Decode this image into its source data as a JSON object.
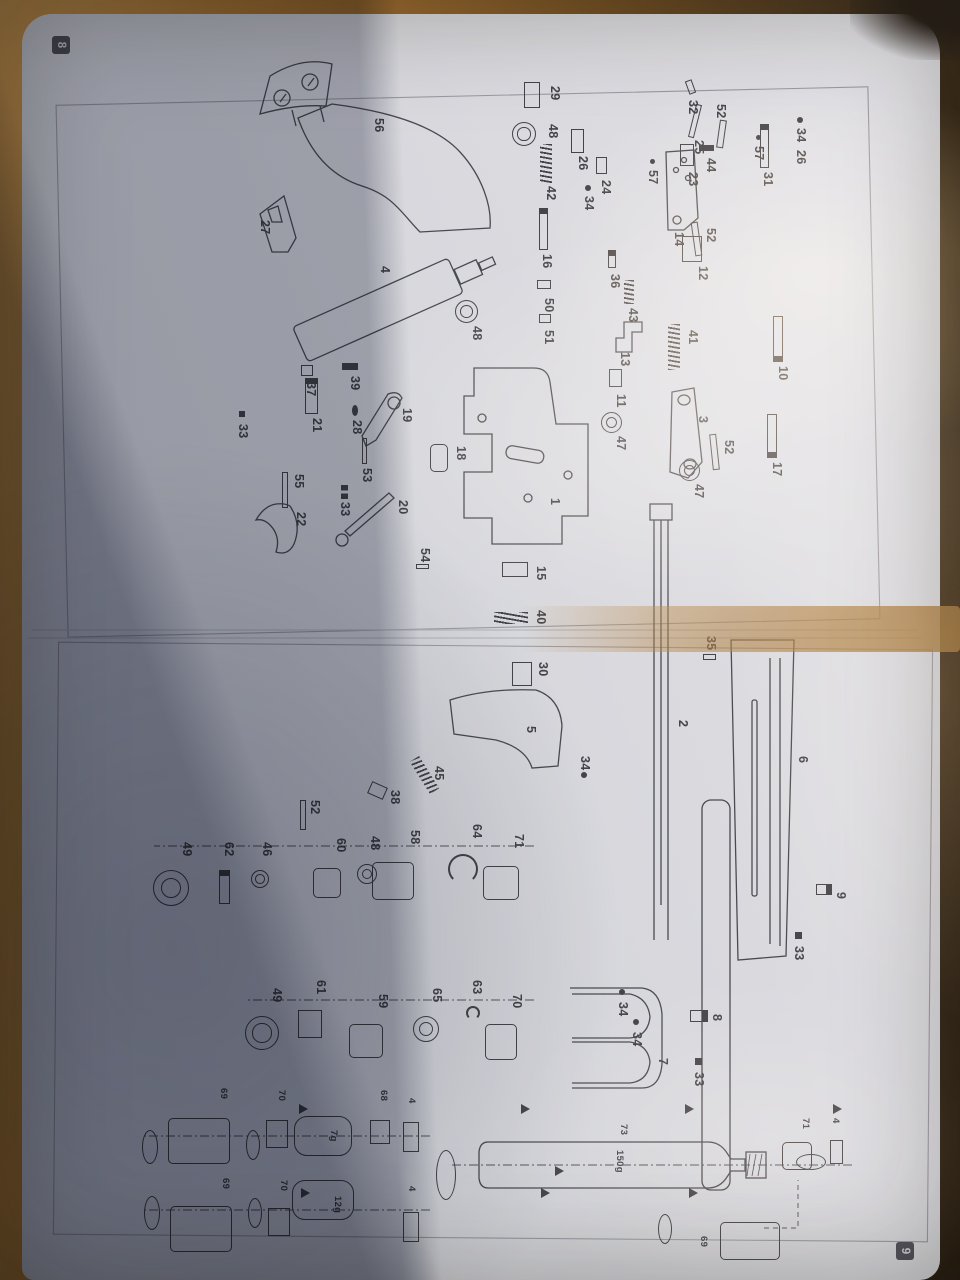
{
  "document": {
    "type": "exploded-parts-diagram",
    "badges": {
      "page_left": "8",
      "page_right": "9"
    }
  },
  "colors": {
    "ink": "#43434a",
    "paper": "#d8d8dc",
    "table": "#b97c35"
  },
  "diagram": {
    "capsules": {
      "small": "7g",
      "medium": "12g",
      "bottle": "150g",
      "bottle_part": "73"
    },
    "parts": [
      {
        "l": "56",
        "x": 118,
        "y": 572
      },
      {
        "l": "32",
        "x": 100,
        "y": 258,
        "k": "pin",
        "sx": -20,
        "sy": 8,
        "sw": 14,
        "sh": 7,
        "r": -20
      },
      {
        "l": "25",
        "x": 140,
        "y": 252,
        "k": "pin",
        "sx": -36,
        "sy": 10,
        "sw": 34,
        "sh": 6,
        "r": 14
      },
      {
        "l": "23",
        "x": 172,
        "y": 258,
        "k": "rect",
        "sx": -28,
        "sy": 8,
        "sw": 22,
        "sh": 14
      },
      {
        "l": "52",
        "x": 104,
        "y": 230,
        "k": "pin",
        "sx": 16,
        "sy": 5,
        "sw": 28,
        "sh": 7,
        "r": 8
      },
      {
        "l": "29",
        "x": 86,
        "y": 396,
        "k": "rect",
        "sx": -4,
        "sy": 24,
        "sw": 26,
        "sh": 16
      },
      {
        "l": "48",
        "x": 124,
        "y": 398,
        "k": "ring2",
        "sx": -2,
        "sy": 26,
        "sw": 24,
        "sh": 24
      },
      {
        "l": "34",
        "x": 128,
        "y": 150,
        "k": "dot",
        "sx": -11,
        "sy": 7,
        "sw": 6,
        "sh": 6
      },
      {
        "l": "26",
        "x": 150,
        "y": 150
      },
      {
        "l": "57",
        "x": 146,
        "y": 192,
        "k": "dot",
        "sx": -11,
        "sy": 7,
        "sw": 5,
        "sh": 5
      },
      {
        "l": "44",
        "x": 158,
        "y": 240,
        "k": "bar",
        "sx": -13,
        "sy": 6,
        "sw": 6,
        "sh": 15
      },
      {
        "l": "31",
        "x": 172,
        "y": 183,
        "k": "screwh",
        "sx": -48,
        "sy": 8,
        "sw": 44,
        "sh": 9
      },
      {
        "l": "52",
        "x": 228,
        "y": 240,
        "k": "pin",
        "sx": -6,
        "sy": 20,
        "sw": 34,
        "sh": 7,
        "r": -8
      },
      {
        "l": "14",
        "x": 232,
        "y": 272
      },
      {
        "l": "26",
        "x": 156,
        "y": 368,
        "k": "rect",
        "sx": -27,
        "sy": 8,
        "sw": 24,
        "sh": 13
      },
      {
        "l": "24",
        "x": 180,
        "y": 345,
        "k": "rect",
        "sx": -23,
        "sy": 8,
        "sw": 17,
        "sh": 11
      },
      {
        "l": "34",
        "x": 196,
        "y": 362,
        "k": "dot",
        "sx": -11,
        "sy": 7,
        "sw": 6,
        "sh": 6
      },
      {
        "l": "57",
        "x": 170,
        "y": 298,
        "k": "dot",
        "sx": -11,
        "sy": 7,
        "sw": 5,
        "sh": 5
      },
      {
        "l": "42",
        "x": 186,
        "y": 400,
        "k": "spring",
        "sx": -42,
        "sy": 8,
        "sw": 40,
        "sh": 12
      },
      {
        "l": "27",
        "x": 220,
        "y": 686
      },
      {
        "l": "16",
        "x": 254,
        "y": 404,
        "k": "screwh",
        "sx": -46,
        "sy": 8,
        "sw": 42,
        "sh": 9
      },
      {
        "l": "4",
        "x": 266,
        "y": 566
      },
      {
        "l": "12",
        "x": 266,
        "y": 248,
        "k": "rect",
        "sx": -30,
        "sy": 10,
        "sw": 26,
        "sh": 20
      },
      {
        "l": "36",
        "x": 274,
        "y": 336,
        "k": "screwh",
        "sx": -24,
        "sy": 8,
        "sw": 18,
        "sh": 8
      },
      {
        "l": "50",
        "x": 298,
        "y": 402,
        "k": "rect",
        "sx": -18,
        "sy": 7,
        "sw": 9,
        "sh": 14
      },
      {
        "l": "43",
        "x": 308,
        "y": 318,
        "k": "spring",
        "sx": -28,
        "sy": 8,
        "sw": 24,
        "sh": 10
      },
      {
        "l": "51",
        "x": 330,
        "y": 402,
        "k": "rect",
        "sx": -16,
        "sy": 7,
        "sw": 9,
        "sh": 12
      },
      {
        "l": "41",
        "x": 330,
        "y": 258,
        "k": "spring",
        "sx": -6,
        "sy": 22,
        "sw": 46,
        "sh": 12
      },
      {
        "l": "13",
        "x": 352,
        "y": 326
      },
      {
        "l": "48",
        "x": 326,
        "y": 474,
        "k": "ring2",
        "sx": -26,
        "sy": 8,
        "sw": 23,
        "sh": 23
      },
      {
        "l": "10",
        "x": 366,
        "y": 168,
        "k": "screwh",
        "sx": -50,
        "sy": 9,
        "sw": 46,
        "sh": 10,
        "r": 180
      },
      {
        "l": "11",
        "x": 394,
        "y": 330,
        "k": "rect",
        "sx": -25,
        "sy": 8,
        "sw": 18,
        "sh": 13
      },
      {
        "l": "3",
        "x": 416,
        "y": 248
      },
      {
        "l": "47",
        "x": 436,
        "y": 330,
        "k": "ring2",
        "sx": -24,
        "sy": 8,
        "sw": 21,
        "sh": 21
      },
      {
        "l": "52",
        "x": 440,
        "y": 222,
        "k": "pin",
        "sx": -6,
        "sy": 20,
        "sw": 36,
        "sh": 7,
        "r": -6
      },
      {
        "l": "17",
        "x": 462,
        "y": 174,
        "k": "screwh",
        "sx": -48,
        "sy": 9,
        "sw": 44,
        "sh": 10,
        "r": 180
      },
      {
        "l": "47",
        "x": 484,
        "y": 252,
        "k": "ring2",
        "sx": -24,
        "sy": 8,
        "sw": 21,
        "sh": 21
      },
      {
        "l": "39",
        "x": 376,
        "y": 596,
        "k": "bar",
        "sx": -13,
        "sy": 6,
        "sw": 7,
        "sh": 16
      },
      {
        "l": "37",
        "x": 382,
        "y": 640,
        "k": "rect",
        "sx": -17,
        "sy": 7,
        "sw": 11,
        "sh": 12
      },
      {
        "l": "19",
        "x": 408,
        "y": 544
      },
      {
        "l": "21",
        "x": 418,
        "y": 634,
        "k": "screwh",
        "sx": -40,
        "sy": 8,
        "sw": 36,
        "sh": 13
      },
      {
        "l": "28",
        "x": 420,
        "y": 594,
        "k": "dot",
        "sx": -15,
        "sy": 8,
        "sw": 11,
        "sh": 6
      },
      {
        "l": "33",
        "x": 424,
        "y": 708,
        "k": "bar",
        "sx": -13,
        "sy": 7,
        "sw": 6,
        "sh": 6
      },
      {
        "l": "53",
        "x": 468,
        "y": 584,
        "k": "pin",
        "sx": -30,
        "sy": 9,
        "sw": 26,
        "sh": 5
      },
      {
        "l": "18",
        "x": 446,
        "y": 490,
        "k": "rrect",
        "sx": -2,
        "sy": 22,
        "sw": 28,
        "sh": 18
      },
      {
        "l": "55",
        "x": 474,
        "y": 652,
        "k": "pin",
        "sx": -2,
        "sy": 20,
        "sw": 36,
        "sh": 6
      },
      {
        "l": "22",
        "x": 512,
        "y": 650
      },
      {
        "l": "33",
        "x": 502,
        "y": 606,
        "k": "bar2",
        "sx": -17,
        "sy": 6,
        "sw": 14,
        "sh": 7
      },
      {
        "l": "20",
        "x": 500,
        "y": 548
      },
      {
        "l": "1",
        "x": 498,
        "y": 396
      },
      {
        "l": "54",
        "x": 548,
        "y": 526,
        "k": "pin",
        "sx": 16,
        "sy": 5,
        "sw": 5,
        "sh": 13
      },
      {
        "l": "15",
        "x": 566,
        "y": 410,
        "k": "rect",
        "sx": -4,
        "sy": 22,
        "sw": 15,
        "sh": 26
      },
      {
        "l": "40",
        "x": 610,
        "y": 410,
        "k": "spring",
        "sx": 2,
        "sy": 22,
        "sw": 12,
        "sh": 34
      },
      {
        "l": "35",
        "x": 636,
        "y": 240,
        "k": "pin",
        "sx": 18,
        "sy": 4,
        "sw": 6,
        "sh": 13
      },
      {
        "l": "30",
        "x": 662,
        "y": 408,
        "k": "rect",
        "sx": 0,
        "sy": 20,
        "sw": 24,
        "sh": 20
      },
      {
        "l": "2",
        "x": 720,
        "y": 268
      },
      {
        "l": "5",
        "x": 726,
        "y": 420
      },
      {
        "l": "45",
        "x": 766,
        "y": 512,
        "k": "spring",
        "sx": -10,
        "sy": 18,
        "sw": 38,
        "sh": 11,
        "r": -32
      },
      {
        "l": "34",
        "x": 756,
        "y": 366,
        "k": "dot",
        "sx": 16,
        "sy": 7,
        "sw": 6,
        "sh": 6
      },
      {
        "l": "38",
        "x": 790,
        "y": 556,
        "k": "rect",
        "sx": -6,
        "sy": 18,
        "sw": 13,
        "sh": 17,
        "r": 24
      },
      {
        "l": "52",
        "x": 800,
        "y": 636,
        "k": "pin",
        "sx": 0,
        "sy": 18,
        "sw": 30,
        "sh": 6
      },
      {
        "l": "6",
        "x": 756,
        "y": 148
      },
      {
        "l": "49",
        "x": 842,
        "y": 764,
        "k": "ring2",
        "sx": 28,
        "sy": 7,
        "sw": 36,
        "sh": 36
      },
      {
        "l": "62",
        "x": 842,
        "y": 722,
        "k": "screwh",
        "sx": 28,
        "sy": 8,
        "sw": 34,
        "sh": 11
      },
      {
        "l": "46",
        "x": 842,
        "y": 684,
        "k": "ring2",
        "sx": 28,
        "sy": 7,
        "sw": 18,
        "sh": 18
      },
      {
        "l": "60",
        "x": 838,
        "y": 610,
        "k": "rrect",
        "sx": 30,
        "sy": 9,
        "sw": 30,
        "sh": 28
      },
      {
        "l": "48",
        "x": 836,
        "y": 576,
        "k": "ring2",
        "sx": 28,
        "sy": 7,
        "sw": 20,
        "sh": 20
      },
      {
        "l": "58",
        "x": 830,
        "y": 536,
        "k": "rrect",
        "sx": 32,
        "sy": 10,
        "sw": 38,
        "sh": 42
      },
      {
        "l": "64",
        "x": 824,
        "y": 474,
        "k": "clip",
        "sx": 30,
        "sy": 8,
        "sw": 30,
        "sh": 30
      },
      {
        "l": "71",
        "x": 834,
        "y": 432,
        "k": "rrect",
        "sx": 32,
        "sy": 9,
        "sw": 34,
        "sh": 36
      },
      {
        "l": "9",
        "x": 892,
        "y": 110,
        "k": "screwv",
        "sx": -8,
        "sy": 18,
        "sw": 11,
        "sh": 16
      },
      {
        "l": "33",
        "x": 946,
        "y": 152,
        "k": "bar",
        "sx": -14,
        "sy": 6,
        "sw": 7,
        "sh": 7
      },
      {
        "l": "49",
        "x": 988,
        "y": 674,
        "k": "ring2",
        "sx": 28,
        "sy": 7,
        "sw": 34,
        "sh": 34
      },
      {
        "l": "61",
        "x": 980,
        "y": 630,
        "k": "rect",
        "sx": 30,
        "sy": 8,
        "sw": 28,
        "sh": 24
      },
      {
        "l": "59",
        "x": 994,
        "y": 568,
        "k": "rrect",
        "sx": 30,
        "sy": 9,
        "sw": 34,
        "sh": 34
      },
      {
        "l": "65",
        "x": 988,
        "y": 514,
        "k": "ring2",
        "sx": 28,
        "sy": 7,
        "sw": 26,
        "sh": 26
      },
      {
        "l": "63",
        "x": 980,
        "y": 474,
        "k": "clip",
        "sx": 26,
        "sy": 6,
        "sw": 14,
        "sh": 14
      },
      {
        "l": "70",
        "x": 994,
        "y": 434,
        "k": "rrect",
        "sx": 30,
        "sy": 9,
        "sw": 36,
        "sh": 32
      },
      {
        "l": "34",
        "x": 1002,
        "y": 328,
        "k": "dot",
        "sx": -13,
        "sy": 7,
        "sw": 6,
        "sh": 6
      },
      {
        "l": "34",
        "x": 1032,
        "y": 314,
        "k": "dot",
        "sx": -13,
        "sy": 7,
        "sw": 6,
        "sh": 6
      },
      {
        "l": "8",
        "x": 1014,
        "y": 234,
        "k": "screwv",
        "sx": -4,
        "sy": 18,
        "sw": 12,
        "sh": 18
      },
      {
        "l": "7",
        "x": 1058,
        "y": 288
      },
      {
        "l": "33",
        "x": 1072,
        "y": 252,
        "k": "bar",
        "sx": -14,
        "sy": 6,
        "sw": 7,
        "sh": 7
      },
      {
        "l": "69",
        "x": 1088,
        "y": 726,
        "s": 1,
        "k": "rrect",
        "sx": 30,
        "sy": 4,
        "sw": 46,
        "sh": 62
      },
      {
        "l": "70",
        "x": 1090,
        "y": 668,
        "s": 1,
        "k": "rect",
        "sx": 30,
        "sy": 4,
        "sw": 28,
        "sh": 22
      },
      {
        "l": "7g",
        "x": 1130,
        "y": 616,
        "s": 1,
        "k": "caps",
        "sx": -14,
        "sy": -8,
        "sw": 40,
        "sh": 58
      },
      {
        "l": "68",
        "x": 1090,
        "y": 566,
        "s": 1,
        "k": "rect",
        "sx": 30,
        "sy": 4,
        "sw": 24,
        "sh": 20
      },
      {
        "l": "4",
        "x": 1098,
        "y": 538,
        "s": 1,
        "k": "rect",
        "sx": 24,
        "sy": 3,
        "sw": 30,
        "sh": 16
      },
      {
        "l": "",
        "x": 1120,
        "y": 796,
        "k": "ellipse",
        "sx": 10,
        "sy": 6,
        "sw": 34,
        "sh": 16
      },
      {
        "l": "",
        "x": 1120,
        "y": 694,
        "k": "ellipse",
        "sx": 10,
        "sy": 6,
        "sw": 30,
        "sh": 14
      },
      {
        "l": "69",
        "x": 1178,
        "y": 724,
        "s": 1,
        "k": "rrect",
        "sx": 28,
        "sy": 4,
        "sw": 46,
        "sh": 62
      },
      {
        "l": "70",
        "x": 1180,
        "y": 666,
        "s": 1,
        "k": "rect",
        "sx": 28,
        "sy": 4,
        "sw": 28,
        "sh": 22
      },
      {
        "l": "12g",
        "x": 1196,
        "y": 612,
        "s": 1,
        "k": "caps",
        "sx": -16,
        "sy": -6,
        "sw": 40,
        "sh": 62
      },
      {
        "l": "4",
        "x": 1186,
        "y": 538,
        "s": 1,
        "k": "rect",
        "sx": 26,
        "sy": 3,
        "sw": 30,
        "sh": 16
      },
      {
        "l": "",
        "x": 1186,
        "y": 794,
        "k": "ellipse",
        "sx": 10,
        "sy": 6,
        "sw": 34,
        "sh": 16
      },
      {
        "l": "",
        "x": 1188,
        "y": 692,
        "k": "ellipse",
        "sx": 10,
        "sy": 6,
        "sw": 30,
        "sh": 14
      },
      {
        "l": "73",
        "x": 1124,
        "y": 326,
        "s": 1
      },
      {
        "l": "150g",
        "x": 1150,
        "y": 330,
        "s": 1
      },
      {
        "l": "71",
        "x": 1118,
        "y": 144,
        "s": 1,
        "k": "rrect",
        "sx": 24,
        "sy": 4,
        "sw": 28,
        "sh": 30
      },
      {
        "l": "4",
        "x": 1118,
        "y": 114,
        "s": 1,
        "k": "rect",
        "sx": 22,
        "sy": 3,
        "sw": 24,
        "sh": 13
      },
      {
        "l": "69",
        "x": 1236,
        "y": 246,
        "s": 1,
        "k": "rrect",
        "sx": -14,
        "sy": -66,
        "sw": 38,
        "sh": 60
      },
      {
        "l": "",
        "x": 1206,
        "y": 282,
        "k": "ellipse",
        "sx": 8,
        "sy": 6,
        "sw": 30,
        "sh": 14
      },
      {
        "l": "",
        "x": 1140,
        "y": 496,
        "k": "ellipse",
        "sx": 10,
        "sy": 8,
        "sw": 50,
        "sh": 20
      },
      {
        "l": "",
        "x": 1146,
        "y": 128,
        "k": "ellipse",
        "sx": 8,
        "sy": 6,
        "sw": 16,
        "sh": 30
      },
      {
        "l": "",
        "x": 1104,
        "y": 652,
        "k": "arw"
      },
      {
        "l": "",
        "x": 1104,
        "y": 430,
        "k": "arw"
      },
      {
        "l": "",
        "x": 1104,
        "y": 266,
        "k": "arw"
      },
      {
        "l": "",
        "x": 1104,
        "y": 118,
        "k": "arw"
      },
      {
        "l": "",
        "x": 1188,
        "y": 650,
        "k": "arw"
      },
      {
        "l": "",
        "x": 1188,
        "y": 410,
        "k": "arw"
      },
      {
        "l": "",
        "x": 1188,
        "y": 262,
        "k": "arw"
      },
      {
        "l": "",
        "x": 1166,
        "y": 396,
        "k": "arw"
      }
    ]
  }
}
